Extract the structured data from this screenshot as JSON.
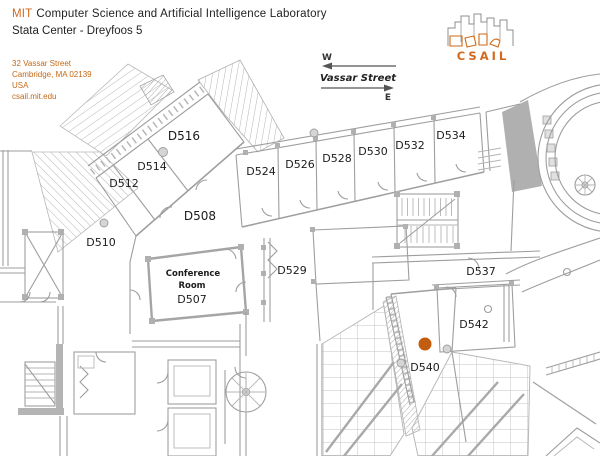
{
  "header": {
    "org_prefix": "MIT",
    "org_name": "Computer Science and Artificial Intelligence Laboratory",
    "subtitle": "Stata Center - Dreyfoos 5"
  },
  "address": {
    "line1": "32 Vassar Street",
    "line2": "Cambridge, MA 02139",
    "line3": "USA",
    "line4": "csail.mit.edu"
  },
  "compass": {
    "west": "W",
    "east": "E",
    "street": "Vassar Street"
  },
  "logo": {
    "text": "CSAIL"
  },
  "marker": {
    "room": "D540"
  },
  "colors": {
    "accent_orange": "#D2691E",
    "marker_orange": "#C25C0F",
    "wall_gray": "#9E9E9E"
  },
  "conference": {
    "line1": "Conference",
    "line2": "Room"
  },
  "rooms": [
    {
      "label": "D516"
    },
    {
      "label": "D514"
    },
    {
      "label": "D512"
    },
    {
      "label": "D510"
    },
    {
      "label": "D508"
    },
    {
      "label": "D524"
    },
    {
      "label": "D526"
    },
    {
      "label": "D528"
    },
    {
      "label": "D530"
    },
    {
      "label": "D532"
    },
    {
      "label": "D534"
    },
    {
      "label": "D529"
    },
    {
      "label": "D507"
    },
    {
      "label": "D537"
    },
    {
      "label": "D542"
    },
    {
      "label": "D540"
    }
  ]
}
